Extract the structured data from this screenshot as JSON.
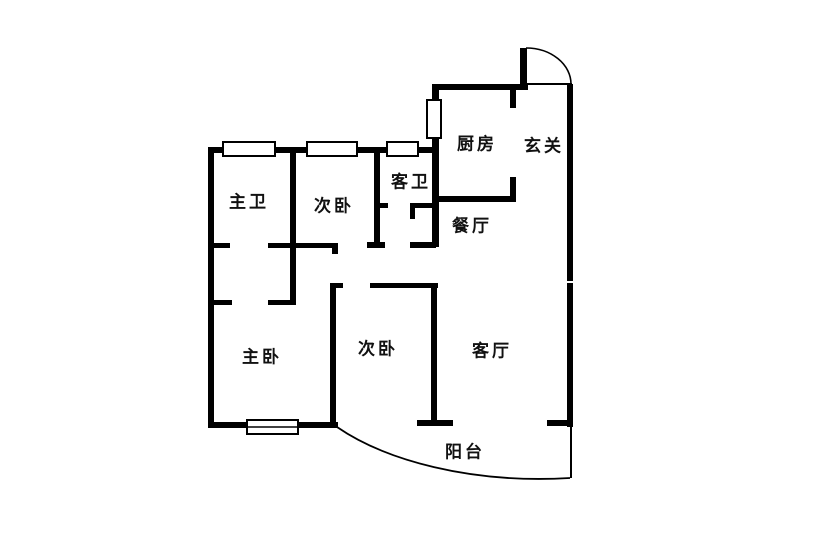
{
  "plan": {
    "rooms": {
      "kitchen": "厨房",
      "foyer": "玄关",
      "guest_bathroom": "客卫",
      "master_bathroom": "主卫",
      "second_bedroom_top": "次卧",
      "dining_room": "餐厅",
      "master_bedroom": "主卧",
      "second_bedroom": "次卧",
      "living_room": "客厅",
      "balcony": "阳台"
    },
    "colors": {
      "wall": "#000000",
      "background": "#ffffff"
    }
  }
}
